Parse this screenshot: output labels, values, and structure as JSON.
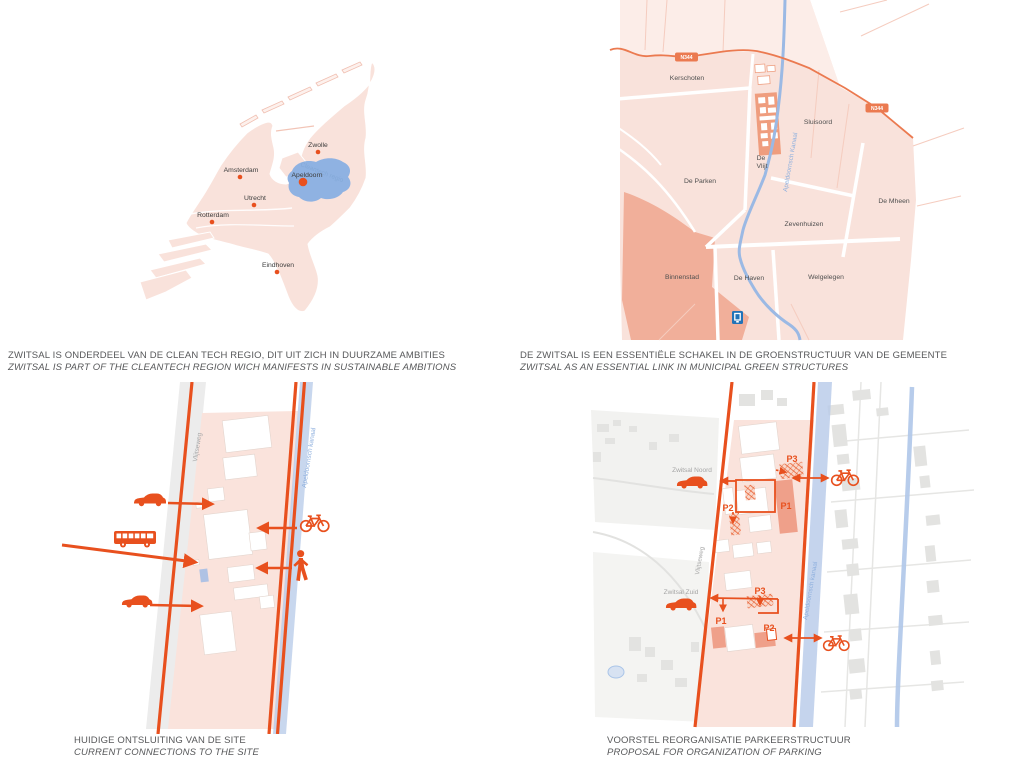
{
  "captions": {
    "cleantech": {
      "nl": "ZWITSAL IS ONDERDEEL VAN DE CLEAN TECH REGIO, DIT UIT ZICH IN DUURZAME AMBITIES",
      "en": "ZWITSAL IS PART OF THE CLEANTECH REGION WICH MANIFESTS IN SUSTAINABLE AMBITIONS"
    },
    "green": {
      "nl": "DE ZWITSAL IS EEN ESSENTIËLE SCHAKEL IN DE GROENSTRUCTUUR VAN DE GEMEENTE",
      "en": "ZWITSAL AS AN ESSENTIAL LINK IN MUNICIPAL GREEN STRUCTURES"
    },
    "connections": {
      "nl": "HUIDIGE ONTSLUITING VAN DE SITE",
      "en": "CURRENT CONNECTIONS TO THE SITE"
    },
    "parking": {
      "nl": "VOORSTEL REORGANISATIE PARKEERSTRUCTUUR",
      "en": "PROPOSAL FOR ORGANIZATION OF PARKING"
    }
  },
  "netherlands_map": {
    "region_label": "Cleantech regio",
    "cities": {
      "zwolle": "Zwolle",
      "amsterdam": "Amsterdam",
      "apeldoorn": "Apeldoorn",
      "utrecht": "Utrecht",
      "rotterdam": "Rotterdam",
      "eindhoven": "Eindhoven"
    }
  },
  "district_map": {
    "districts": {
      "kerschoten": "Kerschoten",
      "sluisoord": "Sluisoord",
      "de_parken": "De Parken",
      "de_vlijt_line1": "De",
      "de_vlijt_line2": "Vlijt",
      "de_mheen": "De Mheen",
      "zevenhuizen": "Zevenhuizen",
      "binnenstad": "Binnenstad",
      "de_haven": "De Haven",
      "welgelegen": "Welgelegen"
    },
    "road_badge": "N344",
    "canal_label": "Apeldoornsch Kanaal"
  },
  "connections_map": {
    "road_label": "Vlijtseweg",
    "canal_label": "Apeldoornsch kanaal"
  },
  "parking_map": {
    "road_label": "Vlijtseweg",
    "canal_label": "Apeldoornsch kanaal",
    "site_noord": "Zwitsal Noord",
    "site_zuid": "Zwitsal Zuid",
    "p": {
      "top_p3": "P3",
      "top_p2": "P2",
      "top_p1": "P1",
      "bottom_p3": "P3",
      "bottom_p1": "P1",
      "bottom_p2": "P2"
    }
  },
  "icons": {
    "car": "car-icon",
    "bus": "bus-icon",
    "bike": "bicycle-icon",
    "pedestrian": "pedestrian-icon",
    "station": "railway-station-icon"
  },
  "colors": {
    "accent_orange": "#E8501E",
    "road_orange": "#EB7A50",
    "pink_light": "#FAE3DC",
    "pink_lighter": "#FCEDE8",
    "salmon_dark": "#F1AF9A",
    "site_salmon": "#EF9D7E",
    "parking_fill": "#EFA08A",
    "canal_blue": "#9BB9E4",
    "region_blue": "#8FB2E2",
    "station_blue": "#2273B8",
    "label_gray": "#A5A5A5",
    "caption_gray": "#57585A",
    "context_gray": "#E4E4E2"
  }
}
